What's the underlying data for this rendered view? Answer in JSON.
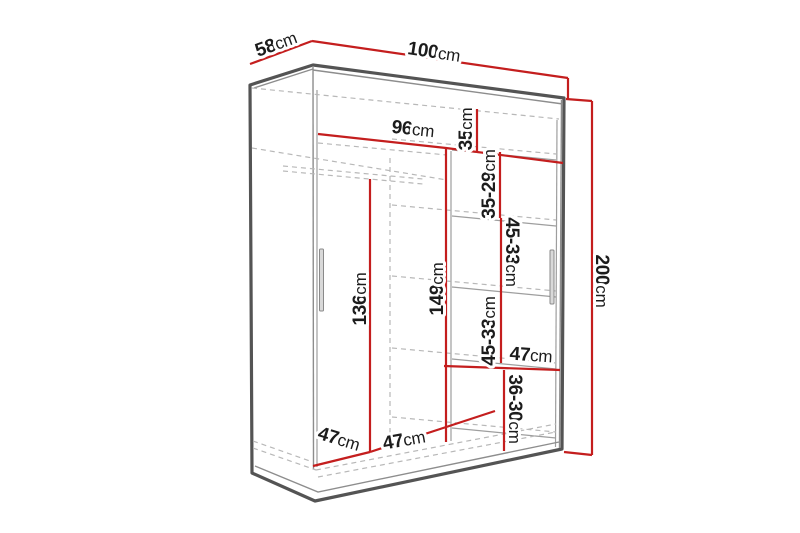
{
  "diagram": {
    "title": "wardrobe-dimension-diagram",
    "colors": {
      "dimension_red": "#c41e1e",
      "outline_dark": "#545454",
      "outline_mid": "#8d8d8d",
      "hidden_dash": "#b8b8b8",
      "label_text": "#1c1c1c",
      "background": "#ffffff"
    },
    "dimensions": {
      "depth": {
        "num": "58",
        "unit": "cm"
      },
      "width": {
        "num": "100",
        "unit": "cm"
      },
      "inner_width": {
        "num": "96",
        "unit": "cm"
      },
      "height": {
        "num": "200",
        "unit": "cm"
      },
      "top_shelf_height": {
        "num": "35",
        "unit": "cm"
      },
      "upper_right_section": {
        "num": "35-29",
        "unit": "cm"
      },
      "mid_right_section_a": {
        "num": "45-33",
        "unit": "cm"
      },
      "mid_right_section_b": {
        "num": "45-33",
        "unit": "cm"
      },
      "left_hanging_height": {
        "num": "136",
        "unit": "cm"
      },
      "middle_hanging_height": {
        "num": "149",
        "unit": "cm"
      },
      "right_shelf_width": {
        "num": "47",
        "unit": "cm"
      },
      "lower_right_section": {
        "num": "36-30",
        "unit": "cm"
      },
      "bottom_left_width": {
        "num": "47",
        "unit": "cm"
      },
      "bottom_middle_width": {
        "num": "47",
        "unit": "cm"
      }
    }
  }
}
